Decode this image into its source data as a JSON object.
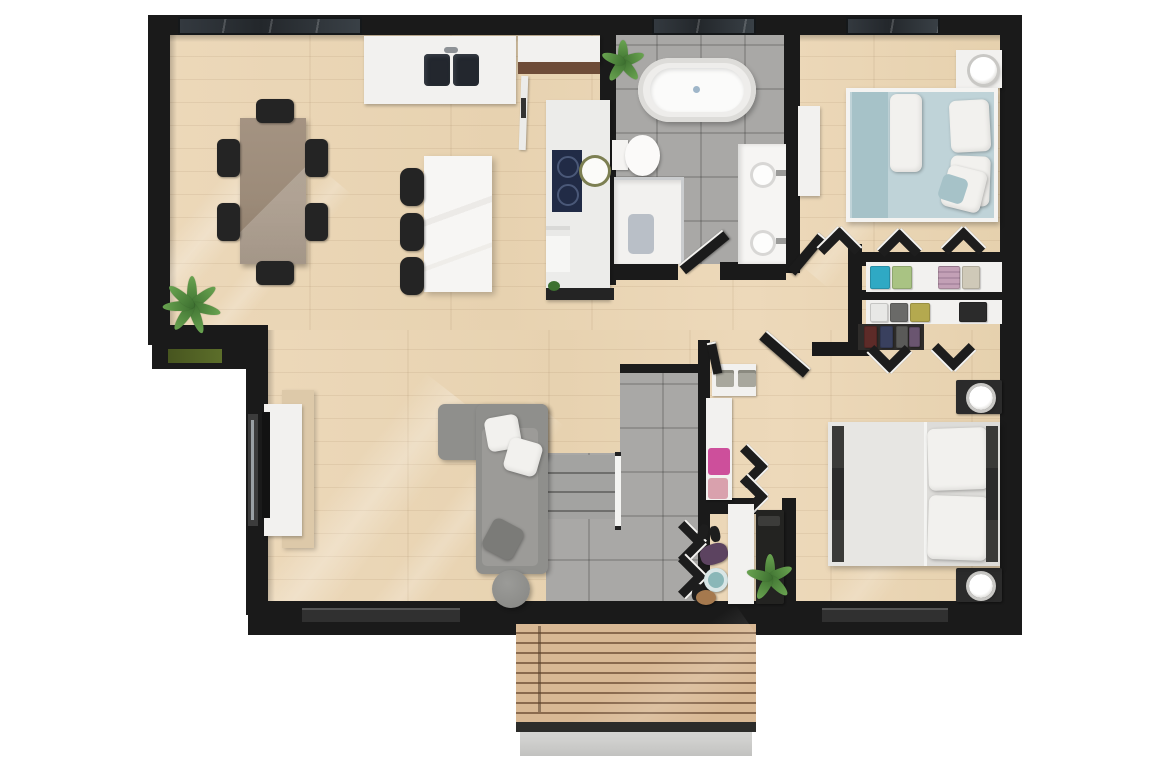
{
  "scene": {
    "type": "3d-rendered floor plan, top-down view",
    "background": "#ffffff",
    "text_visible": "none"
  },
  "palette": {
    "wall": "#1a1a1a",
    "wood": "#ecd8b9",
    "tile": "#a9a8a6",
    "counter": "#f2f1ef",
    "marble": "#f6f5f3",
    "dark": "#242424",
    "sofa": "#8f8f8c",
    "sofaseat": "#9c9b98",
    "pillow": "#f2f1ee",
    "bed1": "#bfd3d8",
    "bed1dark": "#a6c2c8",
    "bed2": "#dddcd9",
    "table": "#9c8b79",
    "cabwood": "#6e4c38",
    "navy": "#212b46",
    "green": "#3d7030",
    "green2": "#69a350",
    "teal": "#2fa9c4",
    "greenshirt": "#a9c383",
    "pink": "#cd4f9b",
    "rose": "#d9a1ad",
    "yellow": "#b4a94f",
    "basket": "#8ab7b8",
    "deck": "#d8b894",
    "deckgap": "#8a6a4e",
    "step": "#cfcfcd",
    "mat": "#b9bfc7",
    "tv": "#121212"
  },
  "rooms": [
    {
      "id": "dining-area",
      "furniture": [
        "wooden dining table",
        "six black chairs",
        "corner palm plant",
        "exterior window planter",
        "large window"
      ]
    },
    {
      "id": "kitchen",
      "furniture": [
        "counter with double sink",
        "tall cabinet with wood top",
        "kitchen island",
        "three bar stools",
        "cooktop counter with round basin",
        "oven unit"
      ]
    },
    {
      "id": "bathroom",
      "furniture": [
        "freestanding oval bathtub",
        "toilet",
        "walk-in shower with mat",
        "double sink marble vanity",
        "plant",
        "window"
      ]
    },
    {
      "id": "bedroom-1",
      "furniture": [
        "double bed with light blue bedding",
        "two white pillows",
        "white throw",
        "nightstand with round lamp",
        "white dresser",
        "open wardrobe doors",
        "window"
      ]
    },
    {
      "id": "walk-in-closet",
      "furniture": [
        "shelf with folded colored clothes",
        "shelf with shirts",
        "hanging clothes rail",
        "open folding doors"
      ]
    },
    {
      "id": "hallway",
      "furniture": [
        "storage niche with two gray boxes",
        "linen shelf with pink boxes",
        "swing doors"
      ]
    },
    {
      "id": "living-room",
      "furniture": [
        "L-shaped gray sofa",
        "white throw pillows",
        "gray round pouf",
        "tv sideboard",
        "wall-mounted tv",
        "side window"
      ]
    },
    {
      "id": "entry-stair-hall",
      "furniture": [
        "staircase with railing",
        "tiled floor",
        "coat hooks with jackets",
        "shoes",
        "white shoe bench",
        "dark console with plant",
        "teal basket",
        "small stool"
      ]
    },
    {
      "id": "bedroom-2",
      "furniture": [
        "double bed with white bedding",
        "two dark nightstands with round lamps",
        "bed side rails",
        "window"
      ]
    },
    {
      "id": "deck",
      "furniture": [
        "wood plank decking",
        "concrete step"
      ]
    }
  ]
}
